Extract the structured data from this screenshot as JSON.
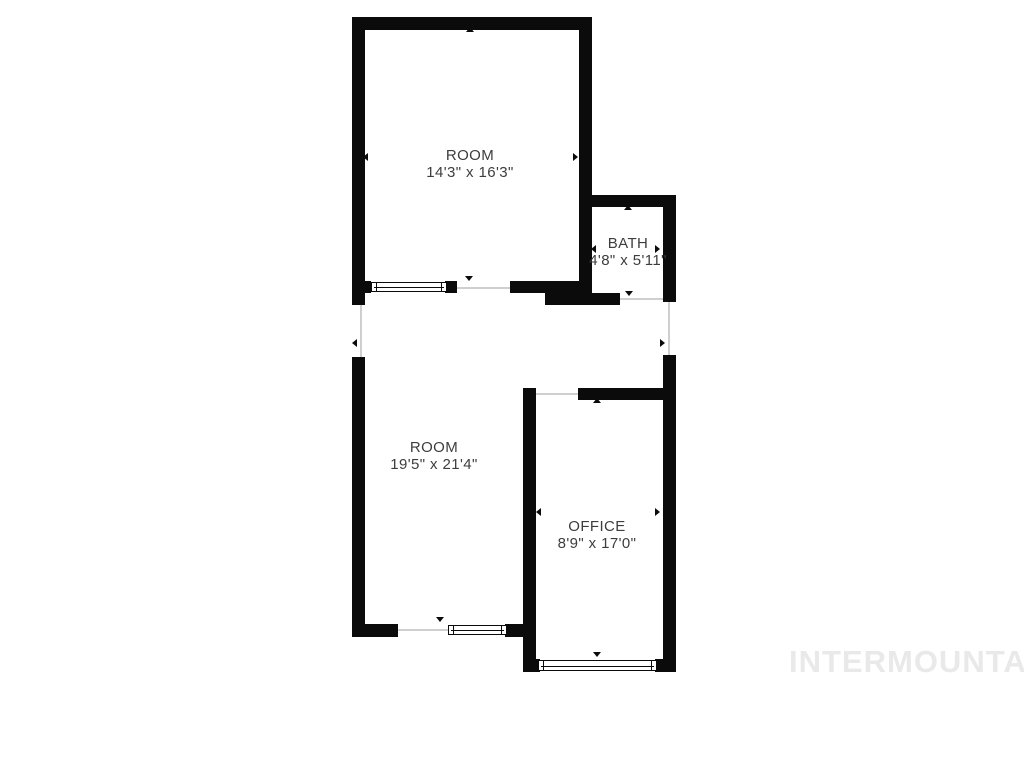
{
  "colors": {
    "background": "#ffffff",
    "wall": "#0b0b0b",
    "label": "#3d3d3d",
    "opening_line": "#cfcfcf",
    "watermark": "#e9e9e9"
  },
  "watermark": {
    "text": "INTERMOUNTAIN",
    "x": 789,
    "y": 644
  },
  "rooms": [
    {
      "id": "room-top",
      "name": "ROOM",
      "dimensions": "14'3\" x 16'3\"",
      "cx": 470,
      "top": 147
    },
    {
      "id": "bath",
      "name": "BATH",
      "dimensions": "4'8\" x 5'11\"",
      "cx": 628,
      "top": 235
    },
    {
      "id": "room-lower",
      "name": "ROOM",
      "dimensions": "19'5\" x 21'4\"",
      "cx": 434,
      "top": 439
    },
    {
      "id": "office",
      "name": "OFFICE",
      "dimensions": "8'9\" x 17'0\"",
      "cx": 597,
      "top": 518
    }
  ],
  "floorplan": {
    "walls": [
      [
        352,
        17,
        240,
        13
      ],
      [
        352,
        17,
        13,
        288
      ],
      [
        579,
        17,
        13,
        288
      ],
      [
        579,
        195,
        97,
        12
      ],
      [
        663,
        195,
        13,
        107
      ],
      [
        545,
        293,
        75,
        12
      ],
      [
        352,
        281,
        19,
        12
      ],
      [
        445,
        281,
        12,
        12
      ],
      [
        510,
        281,
        82,
        12
      ],
      [
        352,
        357,
        13,
        280
      ],
      [
        352,
        624,
        46,
        13
      ],
      [
        505,
        624,
        18,
        13
      ],
      [
        523,
        388,
        13,
        284
      ],
      [
        578,
        388,
        98,
        12
      ],
      [
        663,
        355,
        13,
        317
      ],
      [
        523,
        659,
        17,
        13
      ],
      [
        655,
        659,
        21,
        13
      ]
    ],
    "windows": [
      [
        371,
        282,
        76,
        10
      ],
      [
        448,
        625,
        59,
        10
      ],
      [
        538,
        660,
        119,
        11
      ]
    ],
    "openings": [
      [
        457,
        287,
        53,
        2
      ],
      [
        620,
        298,
        43,
        2
      ],
      [
        360,
        305,
        2,
        52
      ],
      [
        668,
        302,
        2,
        53
      ],
      [
        398,
        629,
        50,
        2
      ],
      [
        536,
        393,
        42,
        2
      ]
    ],
    "arrows": [
      {
        "x": 470,
        "y": 31,
        "dir": "up"
      },
      {
        "x": 367,
        "y": 157,
        "dir": "left"
      },
      {
        "x": 577,
        "y": 157,
        "dir": "right"
      },
      {
        "x": 469,
        "y": 280,
        "dir": "down"
      },
      {
        "x": 628,
        "y": 209,
        "dir": "up"
      },
      {
        "x": 595,
        "y": 249,
        "dir": "left"
      },
      {
        "x": 659,
        "y": 249,
        "dir": "right"
      },
      {
        "x": 629,
        "y": 295,
        "dir": "down"
      },
      {
        "x": 356,
        "y": 343,
        "dir": "left"
      },
      {
        "x": 664,
        "y": 343,
        "dir": "right"
      },
      {
        "x": 440,
        "y": 621,
        "dir": "down"
      },
      {
        "x": 597,
        "y": 402,
        "dir": "up"
      },
      {
        "x": 540,
        "y": 512,
        "dir": "left"
      },
      {
        "x": 659,
        "y": 512,
        "dir": "right"
      },
      {
        "x": 597,
        "y": 656,
        "dir": "down"
      }
    ]
  }
}
